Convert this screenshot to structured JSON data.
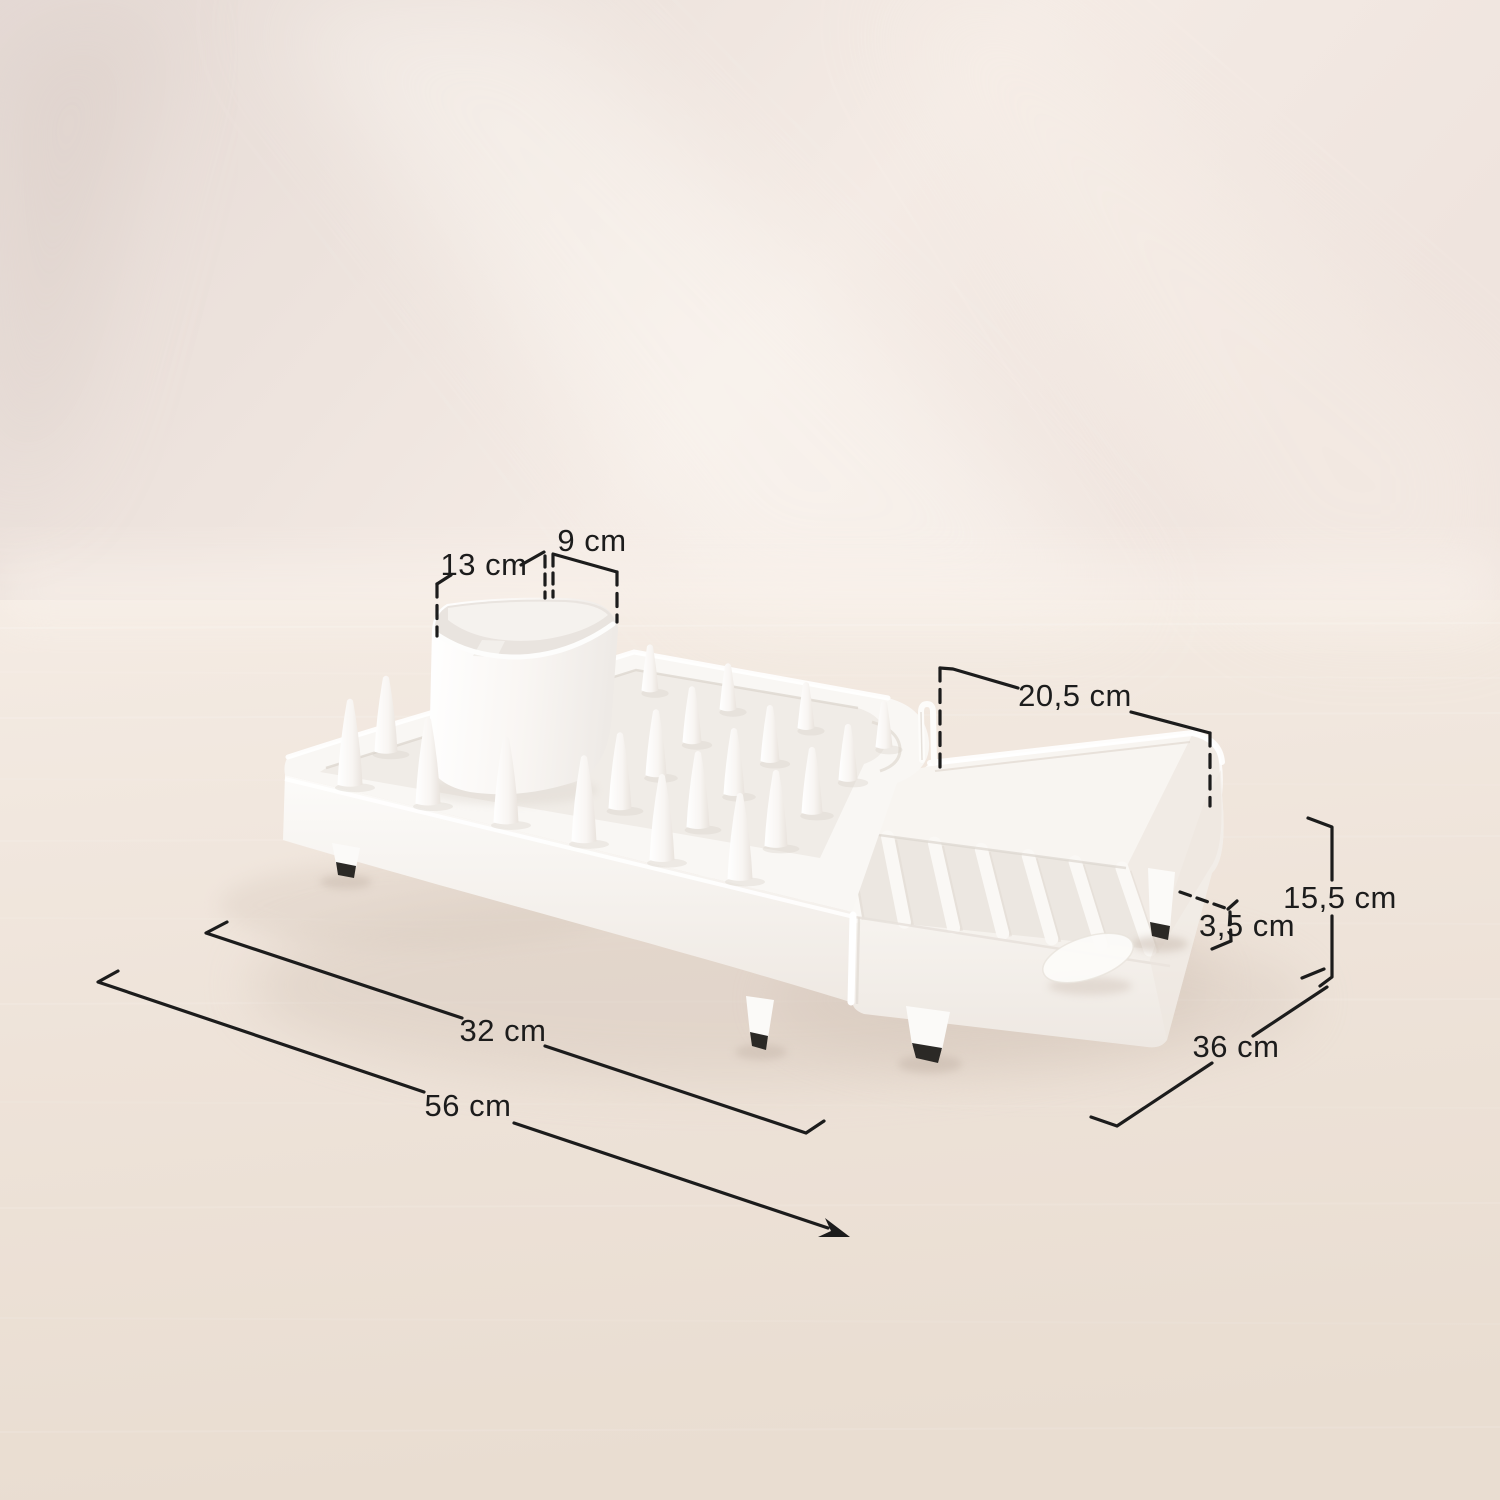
{
  "scene": {
    "type": "product-dimension-photo",
    "product": "expandable dish drying rack with utensil holder"
  },
  "labels": {
    "cup_length": "13 cm",
    "cup_width": "9 cm",
    "drainer_width": "20,5 cm",
    "total_height": "15,5 cm",
    "foot_height": "3,5 cm",
    "depth": "36 cm",
    "compact_length": "32 cm",
    "extended_length": "56 cm"
  },
  "colors": {
    "annotation": "#1c1c1c",
    "product_white": "#f9f7f4",
    "foot_tip": "#2b2926",
    "wall": "#ece2dc",
    "floor": "#f0e6dd",
    "shadow": "#d5c6ba"
  }
}
